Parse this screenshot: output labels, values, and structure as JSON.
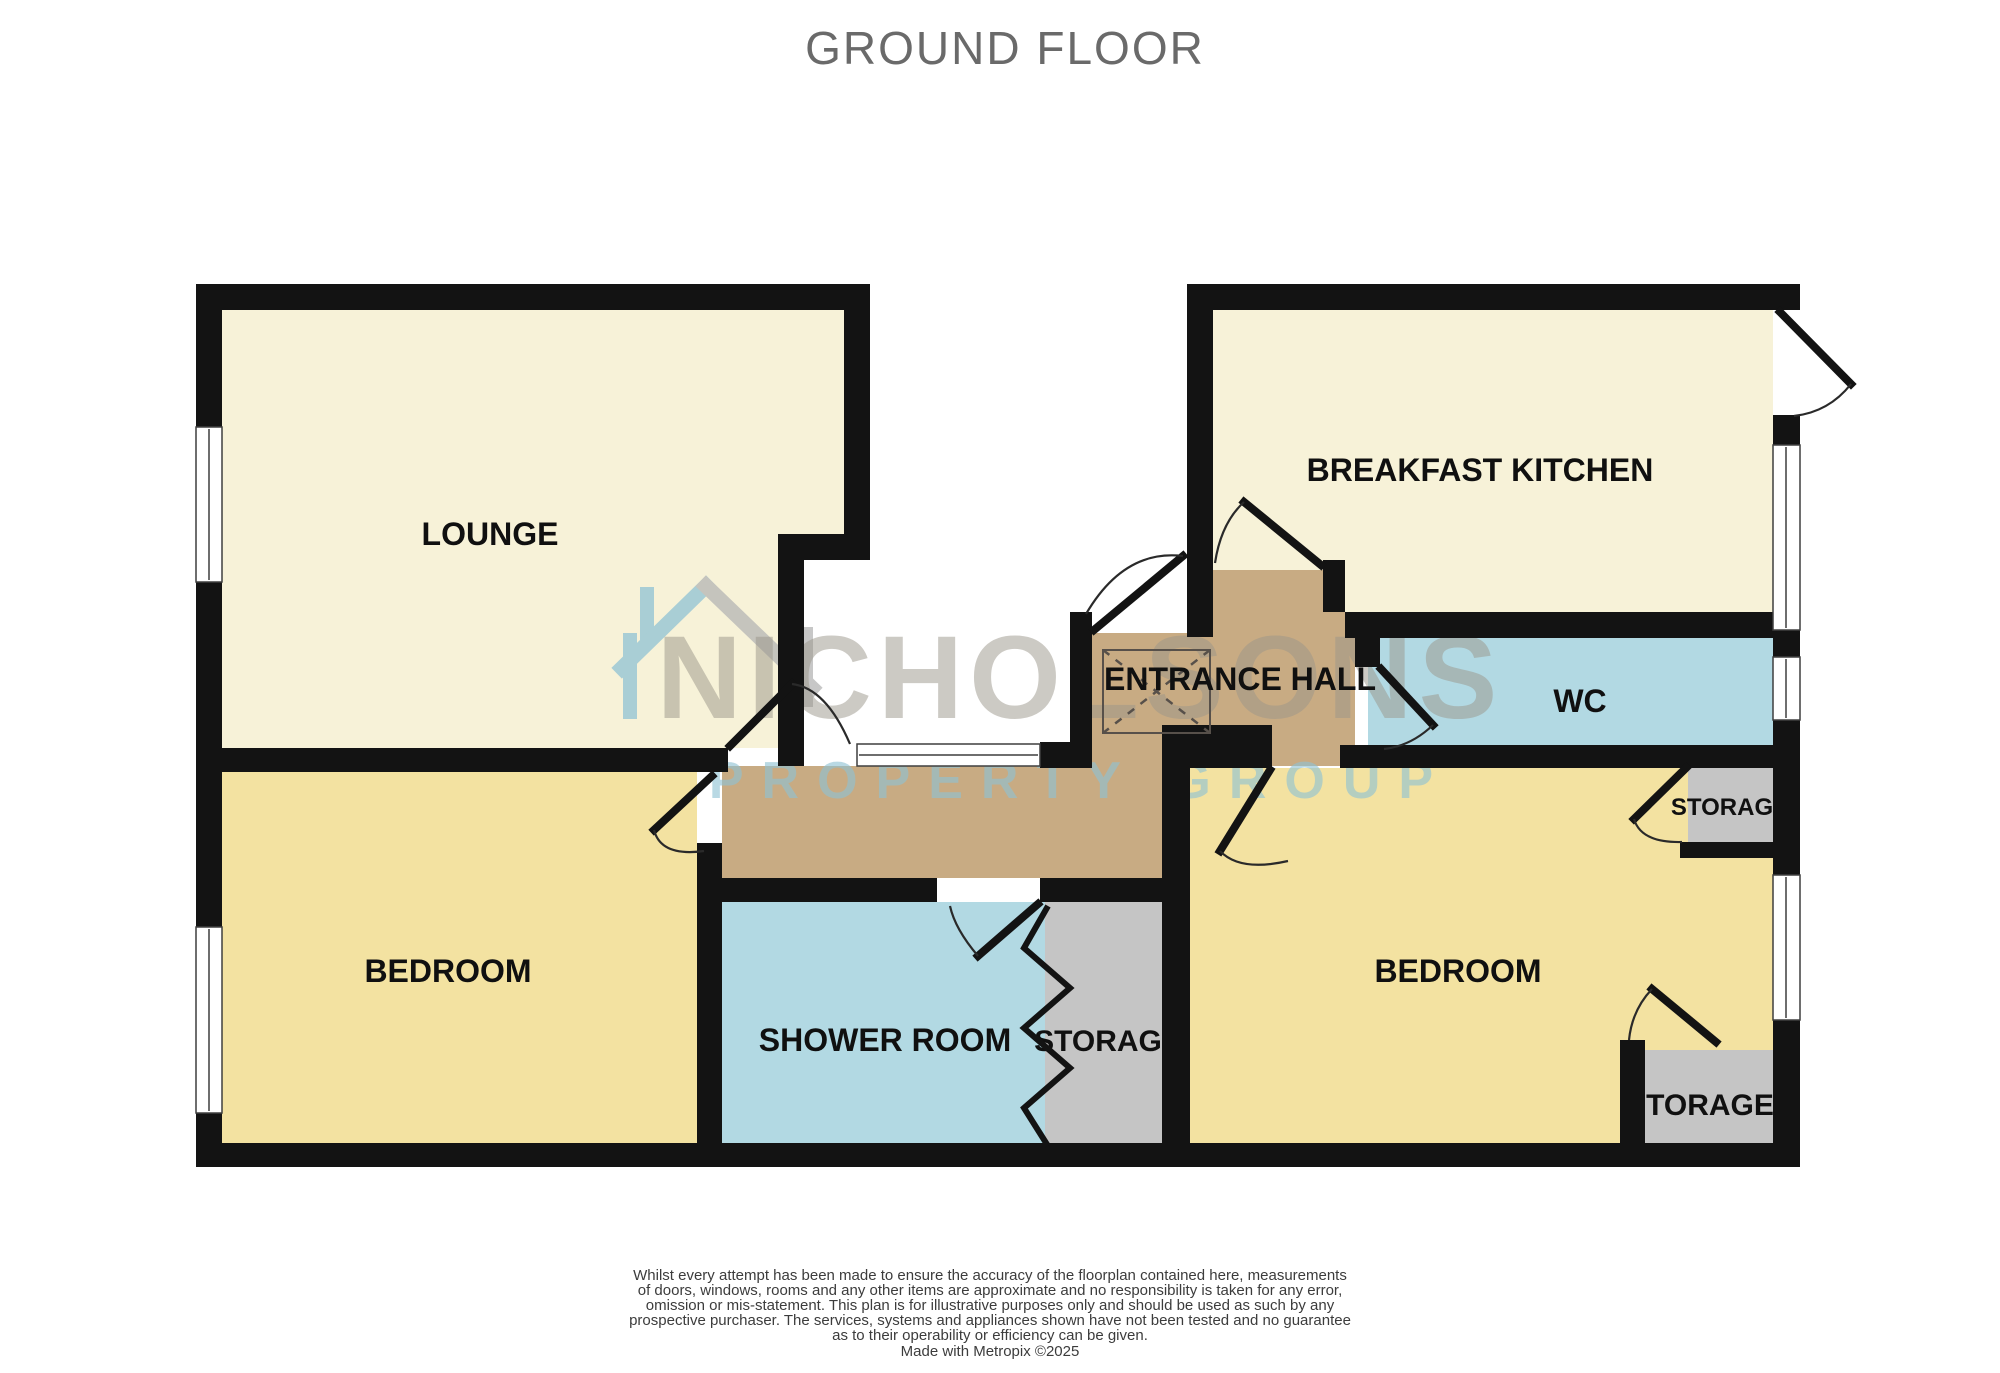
{
  "title": "GROUND FLOOR",
  "watermark": {
    "name": "NICHOLSONS",
    "tagline": "PROPERTY GROUP",
    "house_icon": "house-outline"
  },
  "rooms": {
    "lounge": {
      "label": "LOUNGE"
    },
    "breakfast_kitchen": {
      "label": "BREAKFAST KITCHEN"
    },
    "entrance_hall": {
      "label": "ENTRANCE HALL"
    },
    "wc": {
      "label": "WC"
    },
    "bedroom_left": {
      "label": "BEDROOM"
    },
    "bedroom_right": {
      "label": "BEDROOM"
    },
    "shower_room": {
      "label": "SHOWER ROOM"
    },
    "storage": {
      "label": "STORAGE"
    }
  },
  "disclaimer": {
    "lines": [
      "Whilst every attempt has been made to ensure the accuracy of the floorplan contained here, measurements",
      "of doors, windows, rooms and any other items are approximate and no responsibility is taken for any error,",
      "omission or mis-statement. This plan is for illustrative purposes only and should be used as such by any",
      "prospective purchaser. The services, systems and appliances shown have not been tested and no guarantee",
      "as to their operability or efficiency can be given."
    ],
    "credit": "Made with Metropix ©2025"
  },
  "colors": {
    "room_cream": "#f7f2d8",
    "room_yellow": "#f3e2a1",
    "room_blue": "#b2d9e3",
    "hall_tan": "#c8ab83",
    "storage_gray": "#c5c5c5",
    "wall_black": "#131313",
    "watermark_gray": "#9b968a",
    "watermark_blue": "#8fc2d4",
    "title_gray": "#6a6a6a"
  }
}
